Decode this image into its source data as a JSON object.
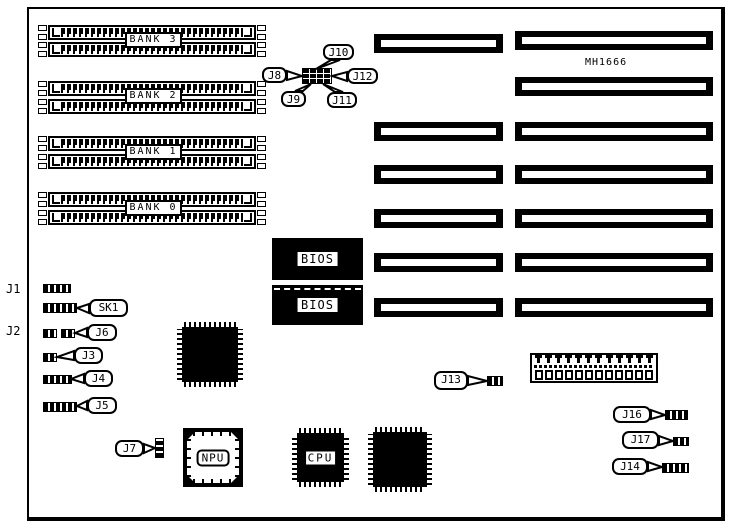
{
  "board": {
    "model_label": "MH1666"
  },
  "memory_banks": [
    {
      "label": "BANK 3"
    },
    {
      "label": "BANK 2"
    },
    {
      "label": "BANK 1"
    },
    {
      "label": "BANK 0"
    }
  ],
  "chips": {
    "bios_top_label": "BIOS",
    "bios_bottom_label": "BIOS",
    "npu_label": "NPU",
    "cpu_label": "CPU"
  },
  "connector_labels": {
    "j1": "J1",
    "j2": "J2",
    "j3": "J3",
    "j4": "J4",
    "j5": "J5",
    "j6": "J6",
    "j7": "J7",
    "j8": "J8",
    "j9": "J9",
    "j10": "J10",
    "j11": "J11",
    "j12": "J12",
    "j13": "J13",
    "j14": "J14",
    "j16": "J16",
    "j17": "J17",
    "sk1": "SK1"
  },
  "expansion_slots": {
    "left_column_count": 6,
    "right_column_count": 7
  },
  "keyboard_header": {
    "pin_count": 12
  },
  "colors": {
    "ink": "#000000",
    "paper": "#ffffff"
  }
}
